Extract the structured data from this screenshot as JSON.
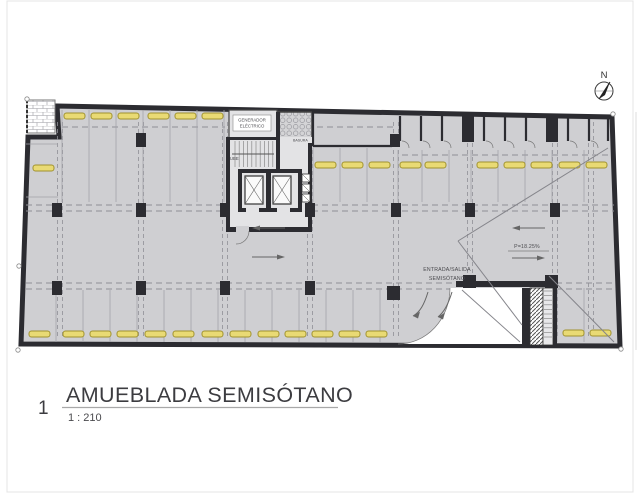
{
  "title_block": {
    "number": "1",
    "title": "AMUEBLADA SEMISÓTANO",
    "scale": "1 : 210"
  },
  "north_arrow": {
    "label": "N"
  },
  "plan": {
    "labels": {
      "generator_line1": "GENERADOR",
      "generator_line2": "ELÉCTRICO",
      "trash": "BASURA",
      "stairs": "SUBE",
      "ramp_slope": "P=18.25%",
      "entrance_line1": "ENTRADA/SALIDA",
      "entrance_line2": "SEMISÓTANO"
    },
    "colors": {
      "floor": "#cfcfd2",
      "wall": "#2c2c31",
      "stop_fill": "#e9da74",
      "stop_stroke": "#a0922f",
      "stall_line": "#a3a3a9",
      "dash": "#8f8f96",
      "label": "#4a4a4e",
      "title": "#3c3c40"
    },
    "geometry": {
      "grid_v": {
        "xs": [
          60,
          141,
          225,
          310,
          396,
          470,
          555,
          591
        ],
        "y1": 122,
        "y2": 338
      },
      "grid_h_double": [
        [
          26,
          228,
          208
        ],
        [
          312,
          614,
          208
        ],
        [
          26,
          614,
          286
        ]
      ],
      "grid_h_single": [
        [
          62,
          225,
          127
        ],
        [
          317,
          393,
          127
        ],
        [
          402,
          608,
          155
        ]
      ],
      "stall_groups": [
        {
          "xs": [
            62,
            89,
            116,
            143,
            170,
            197,
            224
          ],
          "y1": 110,
          "y2": 202
        },
        {
          "xs": [
            313,
            340,
            367
          ],
          "y1": 148,
          "y2": 202
        },
        {
          "xs": [
            398,
            422,
            449,
            471,
            498,
            525,
            552,
            584
          ],
          "y1": 150,
          "y2": 202
        },
        {
          "xs": [
            56,
            83,
            110,
            137,
            164,
            191,
            218,
            245,
            272,
            299,
            326,
            353,
            380
          ],
          "y1": 290,
          "y2": 342
        },
        {
          "xs": [
            557,
            584
          ],
          "y1": 288,
          "y2": 342
        }
      ],
      "stall_hlines": [
        [
          26,
          144,
          58,
          144
        ],
        [
          26,
          197,
          58,
          197
        ]
      ],
      "stop_rows": [
        {
          "y": 113,
          "xs": [
            64,
            91,
            118,
            148,
            175,
            202
          ]
        },
        {
          "y": 162,
          "xs": [
            315,
            342,
            369,
            400,
            425,
            477,
            504,
            531,
            559,
            586
          ]
        },
        {
          "y": 331,
          "xs": [
            29,
            63,
            90,
            117,
            145,
            173,
            202,
            230,
            258,
            285,
            312,
            339,
            366
          ]
        },
        {
          "y": 330,
          "xs": [
            563,
            590
          ]
        }
      ],
      "stop_single": [
        33,
        165
      ],
      "columns": [
        [
          136,
          133,
          10,
          14
        ],
        [
          390,
          134,
          10,
          13
        ],
        [
          462,
          114,
          12,
          28
        ],
        [
          546,
          114,
          12,
          28
        ],
        [
          52,
          203,
          10,
          14
        ],
        [
          136,
          203,
          10,
          14
        ],
        [
          220,
          203,
          10,
          14
        ],
        [
          305,
          203,
          10,
          14
        ],
        [
          391,
          203,
          10,
          14
        ],
        [
          465,
          203,
          10,
          14
        ],
        [
          550,
          203,
          10,
          14
        ],
        [
          52,
          281,
          10,
          14
        ],
        [
          136,
          281,
          10,
          14
        ],
        [
          220,
          281,
          10,
          14
        ],
        [
          305,
          281,
          10,
          14
        ],
        [
          463,
          275,
          13,
          13
        ],
        [
          545,
          275,
          13,
          13
        ],
        [
          387,
          286,
          13,
          14
        ]
      ],
      "bodega": {
        "partitions": [
          400,
          421,
          442,
          484,
          505,
          526,
          568,
          589,
          608
        ],
        "door_arcs": [
          402,
          423,
          444,
          486,
          507,
          528,
          570,
          591
        ]
      }
    }
  }
}
